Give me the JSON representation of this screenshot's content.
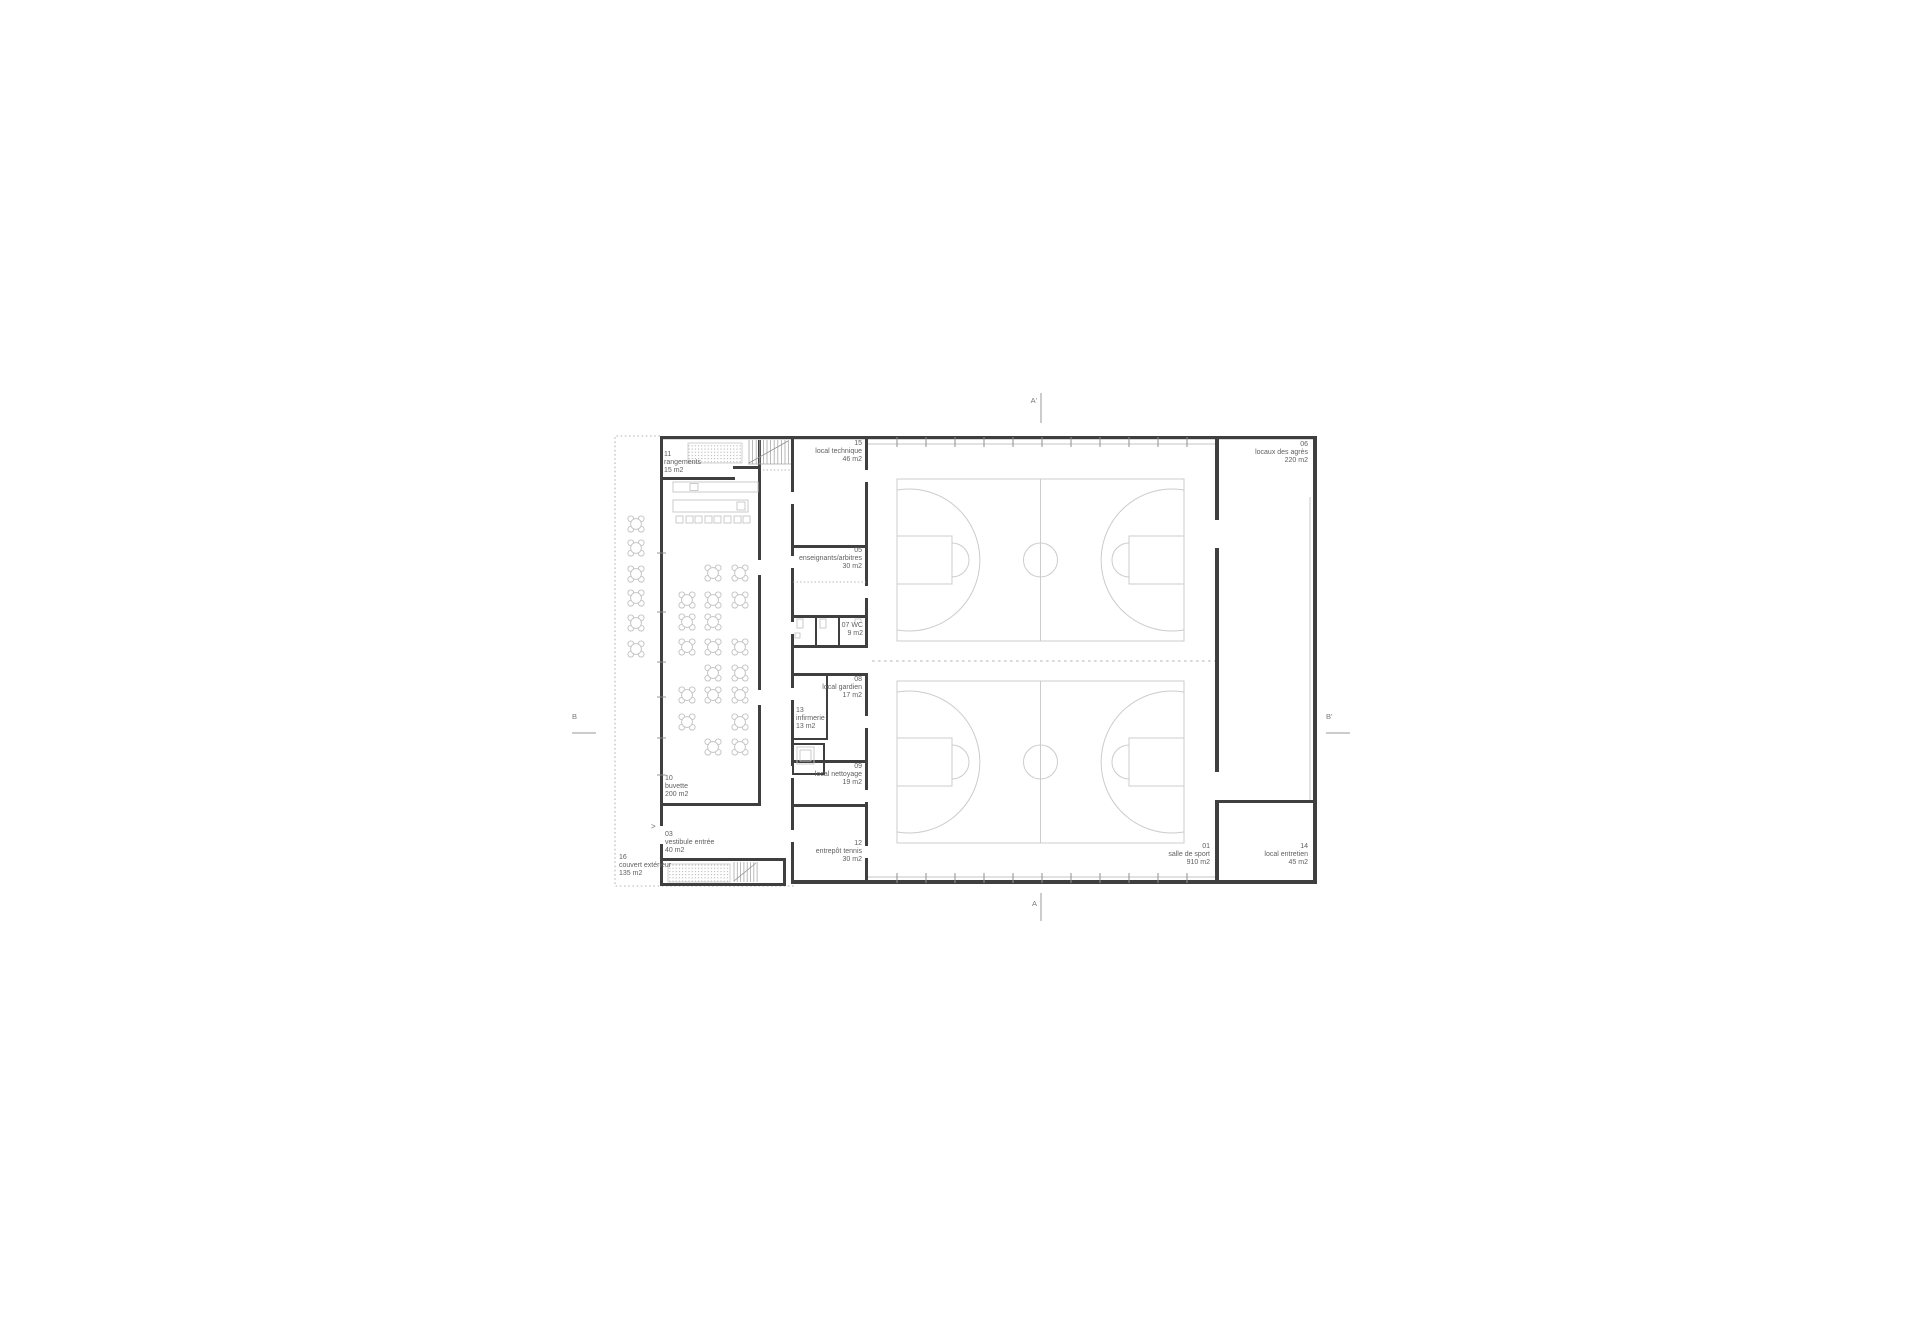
{
  "drawing": {
    "type": "architectural-floor-plan",
    "description": "ground floor plan of a sports hall with buvette and two basketball courts",
    "rooms": [
      {
        "num": "11",
        "name": "rangements",
        "area": "15 m2"
      },
      {
        "num": "15",
        "name": "local technique",
        "area": "46 m2"
      },
      {
        "num": "05",
        "name": "enseignants/arbitres",
        "area": "30 m2"
      },
      {
        "num": "07",
        "name": "WC",
        "area": "9 m2"
      },
      {
        "num": "08",
        "name": "local gardien",
        "area": "17 m2"
      },
      {
        "num": "13",
        "name": "infirmerie",
        "area": "13 m2"
      },
      {
        "num": "09",
        "name": "local nettoyage",
        "area": "19 m2"
      },
      {
        "num": "12",
        "name": "entrepôt tennis",
        "area": "30 m2"
      },
      {
        "num": "10",
        "name": "buvette",
        "area": "200 m2"
      },
      {
        "num": "03",
        "name": "vestibule entrée",
        "area": "40 m2"
      },
      {
        "num": "16",
        "name": "couvert extérieur",
        "area": "135 m2"
      },
      {
        "num": "01",
        "name": "salle de sport",
        "area": "910 m2"
      },
      {
        "num": "06",
        "name": "locaux des agrès",
        "area": "220 m2"
      },
      {
        "num": "14",
        "name": "local entretien",
        "area": "45 m2"
      }
    ],
    "section_markers": [
      {
        "label": "A'"
      },
      {
        "label": "A"
      },
      {
        "label": "B"
      },
      {
        "label": "B'"
      }
    ],
    "entrance_marker": ">",
    "colors": {
      "wall": "#3f3f3f",
      "furniture_line": "#c6c6c6",
      "court_line": "#cccccc",
      "dashed_line": "#9a9a9a",
      "text": "#5f5f5f",
      "background": "#ffffff"
    }
  }
}
